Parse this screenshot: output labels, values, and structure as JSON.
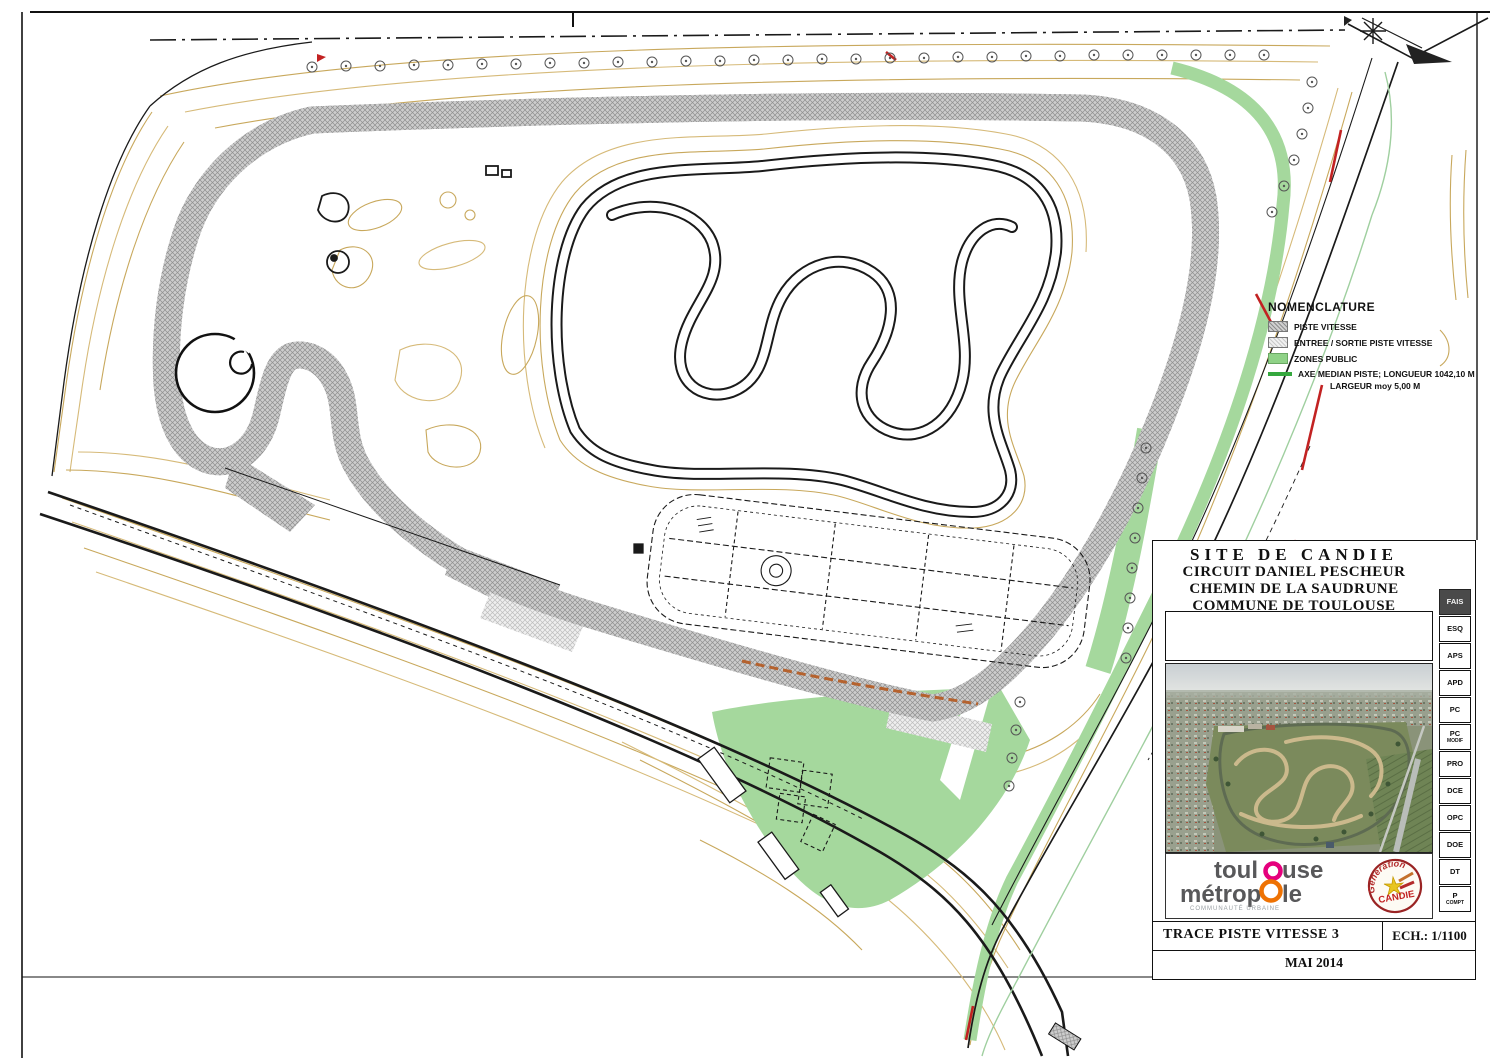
{
  "document": {
    "type": "site-plan technical drawing",
    "site": "SITE DE CANDIE",
    "circuit": "CIRCUIT DANIEL PESCHEUR",
    "address": "CHEMIN DE LA SAUDRUNE",
    "commune": "COMMUNE DE TOULOUSE",
    "drawing_title": "TRACE PISTE VITESSE 3",
    "scale_label": "ECH.: 1/1100",
    "date": "MAI 2014"
  },
  "legend": {
    "title": "NOMENCLATURE",
    "items": [
      {
        "label": "PISTE VITESSE",
        "swatch": "dark-hatch"
      },
      {
        "label": "ENTREE / SORTIE PISTE VITESSE",
        "swatch": "light-hatch"
      },
      {
        "label": "ZONES PUBLIC",
        "swatch": "green-fill"
      },
      {
        "label": "AXE MEDIAN PISTE; LONGUEUR 1042,10 M",
        "swatch": "green-line"
      }
    ],
    "axe_line2": "LARGEUR moy 5,00 M"
  },
  "phase_tabs": [
    {
      "label": "FAIS",
      "active": true
    },
    {
      "label": "ESQ"
    },
    {
      "label": "APS"
    },
    {
      "label": "APD"
    },
    {
      "label": "PC"
    },
    {
      "label": "PC",
      "sub": "MODIF"
    },
    {
      "label": "PRO"
    },
    {
      "label": "DCE"
    },
    {
      "label": "OPC"
    },
    {
      "label": "DOE"
    },
    {
      "label": "DT"
    },
    {
      "label": "P",
      "sub": "COMPT"
    }
  ],
  "logos": {
    "toulouse_metropole": {
      "line1_left": "toul",
      "line1_right": "use",
      "line2_left": "métrop",
      "line2_right": "le",
      "subtitle": "COMMUNAUTÉ URBAINE",
      "text_color": "#58585a",
      "pink": "#e5007d",
      "orange": "#ee7203"
    },
    "candie_stamp": {
      "arc_text": "Génération",
      "name": "CANDIE",
      "ring_color": "#9a2424"
    }
  },
  "map": {
    "colors": {
      "track_hatch": "#c9c9c9",
      "track_hatch_line": "#8f8f8f",
      "median_green": "#3aa53f",
      "public_green": "#a5d89d",
      "contour_tan": "#c8a85c",
      "outline_black": "#1a1a1a",
      "marker_red": "#c22222",
      "service_orange": "#b5622e"
    },
    "features": [
      "speed-track-ring-hatched",
      "green-median-axis",
      "interior-kart-track",
      "hairpin-pond-circle",
      "tree-rows",
      "paddock-road-grid-with-roundabout",
      "public-green-fan",
      "site-boundary-roads",
      "contour-lines",
      "north-entrance"
    ]
  }
}
